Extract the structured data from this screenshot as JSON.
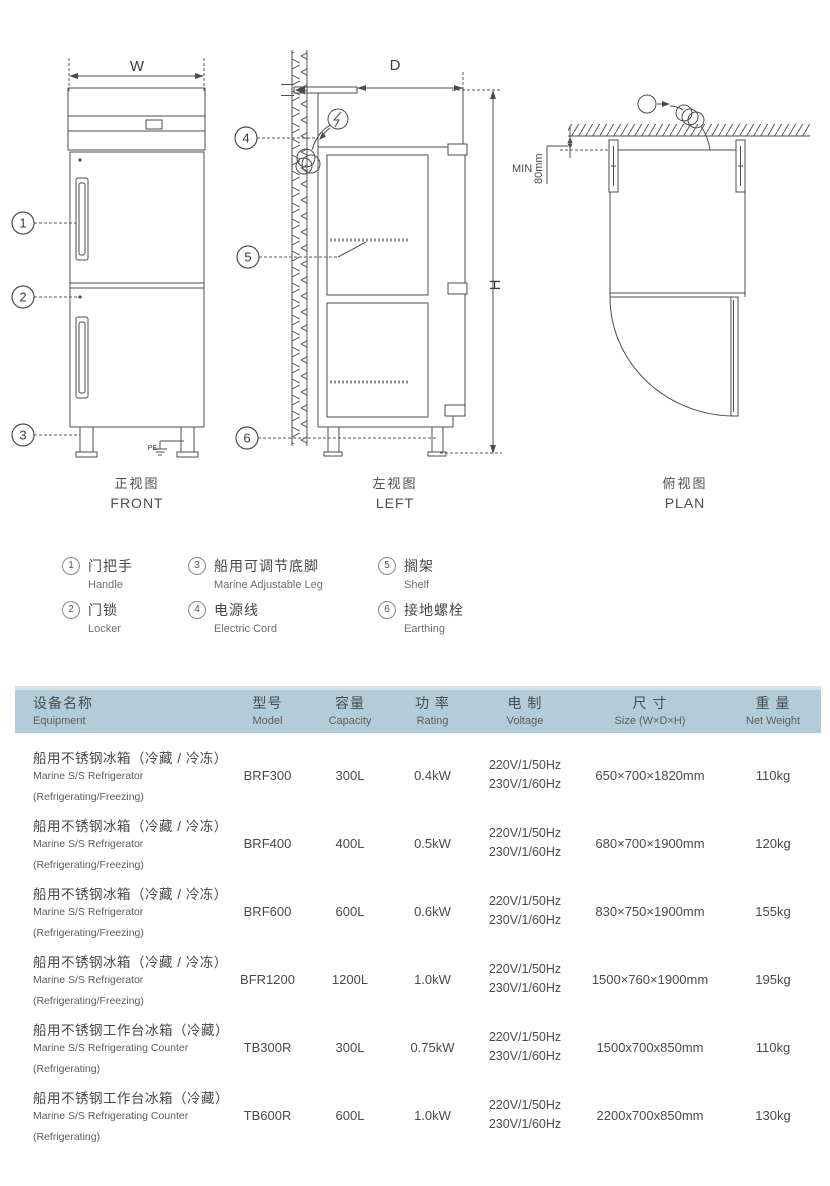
{
  "colors": {
    "line": "#4d4d4d",
    "header_bg": "#b2cdd9",
    "header_bg_light": "#d3e2e9",
    "text_dark": "#474747",
    "text_gray": "#6e6e6e"
  },
  "drawings": {
    "front": {
      "label_cn": "正视图",
      "label_en": "FRONT",
      "dim_width": "W",
      "pe_label": "PE",
      "callout_1": "1",
      "callout_2": "2",
      "callout_3": "3"
    },
    "left": {
      "label_cn": "左视图",
      "label_en": "LEFT",
      "dim_depth": "D",
      "dim_height": "H",
      "callout_4": "4",
      "callout_5": "5",
      "callout_6": "6"
    },
    "plan": {
      "label_cn": "俯视图",
      "label_en": "PLAN",
      "min_label": "MIN",
      "clearance": "80mm"
    }
  },
  "legend": {
    "items": [
      {
        "num": "1",
        "cn": "门把手",
        "en": "Handle"
      },
      {
        "num": "2",
        "cn": "门锁",
        "en": "Locker"
      },
      {
        "num": "3",
        "cn": "船用可调节底脚",
        "en": "Marine Adjustable Leg"
      },
      {
        "num": "4",
        "cn": "电源线",
        "en": "Electric Cord"
      },
      {
        "num": "5",
        "cn": "搁架",
        "en": "Shelf"
      },
      {
        "num": "6",
        "cn": "接地螺栓",
        "en": "Earthing"
      }
    ]
  },
  "table": {
    "header": {
      "equipment_cn": "设备名称",
      "equipment_en": "Equipment",
      "model_cn": "型号",
      "model_en": "Model",
      "capacity_cn": "容量",
      "capacity_en": "Capacity",
      "rating_cn": "功 率",
      "rating_en": "Rating",
      "voltage_cn": "电 制",
      "voltage_en": "Voltage",
      "size_cn": "尺 寸",
      "size_en": "Size (W×D×H)",
      "weight_cn": "重 量",
      "weight_en": "Net Weight"
    },
    "rows": [
      {
        "name_cn": "船用不锈钢冰箱（冷藏 / 冷冻）",
        "name_en": "Marine S/S Refrigerator",
        "name_note": "(Refrigerating/Freezing)",
        "model": "BRF300",
        "capacity": "300L",
        "rating": "0.4kW",
        "voltage_line1": "220V/1/50Hz",
        "voltage_line2": "230V/1/60Hz",
        "size": "650×700×1820mm",
        "weight": "110kg"
      },
      {
        "name_cn": "船用不锈钢冰箱（冷藏 / 冷冻）",
        "name_en": "Marine S/S Refrigerator",
        "name_note": "(Refrigerating/Freezing)",
        "model": "BRF400",
        "capacity": "400L",
        "rating": "0.5kW",
        "voltage_line1": "220V/1/50Hz",
        "voltage_line2": "230V/1/60Hz",
        "size": "680×700×1900mm",
        "weight": "120kg"
      },
      {
        "name_cn": "船用不锈钢冰箱（冷藏 / 冷冻）",
        "name_en": "Marine S/S Refrigerator",
        "name_note": "(Refrigerating/Freezing)",
        "model": "BRF600",
        "capacity": "600L",
        "rating": "0.6kW",
        "voltage_line1": "220V/1/50Hz",
        "voltage_line2": "230V/1/60Hz",
        "size": "830×750×1900mm",
        "weight": "155kg"
      },
      {
        "name_cn": "船用不锈钢冰箱（冷藏 / 冷冻）",
        "name_en": "Marine S/S Refrigerator",
        "name_note": "(Refrigerating/Freezing)",
        "model": "BFR1200",
        "capacity": "1200L",
        "rating": "1.0kW",
        "voltage_line1": "220V/1/50Hz",
        "voltage_line2": "230V/1/60Hz",
        "size": "1500×760×1900mm",
        "weight": "195kg"
      },
      {
        "name_cn": "船用不锈钢工作台冰箱（冷藏）",
        "name_en": "Marine S/S Refrigerating Counter",
        "name_note": "(Refrigerating)",
        "model": "TB300R",
        "capacity": "300L",
        "rating": "0.75kW",
        "voltage_line1": "220V/1/50Hz",
        "voltage_line2": "230V/1/60Hz",
        "size": "1500x700x850mm",
        "weight": "110kg"
      },
      {
        "name_cn": "船用不锈钢工作台冰箱（冷藏）",
        "name_en": "Marine S/S Refrigerating Counter",
        "name_note": "(Refrigerating)",
        "model": "TB600R",
        "capacity": "600L",
        "rating": "1.0kW",
        "voltage_line1": "220V/1/50Hz",
        "voltage_line2": "230V/1/60Hz",
        "size": "2200x700x850mm",
        "weight": "130kg"
      }
    ]
  }
}
